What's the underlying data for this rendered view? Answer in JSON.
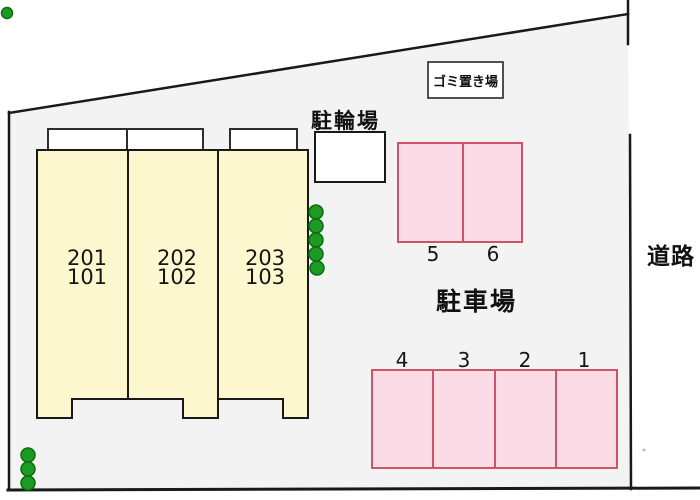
{
  "diagram_type": "residential site plan",
  "building": {
    "units": [
      {
        "upper": "201",
        "lower": "101"
      },
      {
        "upper": "202",
        "lower": "102"
      },
      {
        "upper": "203",
        "lower": "103"
      }
    ]
  },
  "areas": {
    "bicycle_parking_label": "駐輪場",
    "garbage_area_label": "ゴミ置き場",
    "parking_lot_label": "駐車場",
    "road_label": "道路"
  },
  "parking": {
    "upper_row_spaces": [
      "5",
      "6"
    ],
    "lower_row_spaces": [
      "4",
      "3",
      "2",
      "1"
    ]
  },
  "trees": {
    "right_of_building_count": 5,
    "bottom_left_count": 3,
    "top_left_count": 1
  },
  "colors": {
    "site_fill": "#f3f3f3",
    "outline": "#191919",
    "building_fill": "#fcf7cf",
    "balcony_fill": "#ffffff",
    "balcony_stroke": "#2e2e2e",
    "box_fill": "#ffffff",
    "parking_fill": "#fbdbe6",
    "parking_stroke": "#cc5468",
    "tree_fill": "#1c9a21",
    "tree_stroke": "#0a6e10"
  }
}
